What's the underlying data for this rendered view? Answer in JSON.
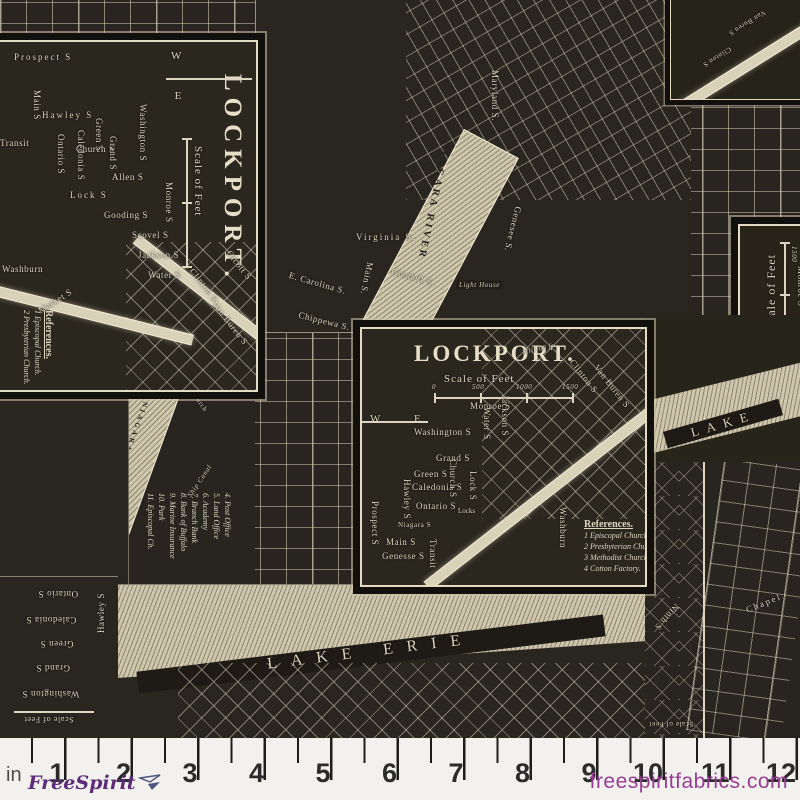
{
  "palette": {
    "background": "#2b2822",
    "line_cream": "#dcd4bd",
    "water": "#cfc6ab",
    "ruler_bg": "#f2f1ee",
    "tick": "#1d1d1d",
    "logo_purple": "#5c2b77",
    "site_purple": "#9a3c96"
  },
  "ruler": {
    "unit": "in",
    "marks": [
      "1",
      "2",
      "3",
      "4",
      "5",
      "6",
      "7",
      "8",
      "9",
      "10",
      "11",
      "12"
    ]
  },
  "brand": {
    "logo": "FreeSpirit",
    "website": "freespiritfabrics.com",
    "glyph": "paper-plane-bird"
  },
  "lockport1": {
    "title": "LOCKPORT.",
    "scale_label": "Scale of Feet",
    "compass": {
      "w": "W",
      "e": "E"
    },
    "streets": {
      "prospect": "Prospect S",
      "main": "Main S",
      "hawley": "Hawley S",
      "transit": "Transit",
      "ontario": "Ontario S",
      "caledonia": "Caledonia S",
      "church": "Church S",
      "green": "Green S",
      "grand": "Grand S",
      "allen": "Allen S",
      "lock": "Lock S",
      "gooding": "Gooding S",
      "scovel": "Scovel S",
      "jackson": "Jackson S",
      "water": "Water S",
      "washington": "Washington S",
      "monroe": "Monroe S",
      "clinton": "Clinton S",
      "vanburen": "Van Buren S",
      "olcott": "Olcott S",
      "washburn": "Washburn",
      "market": "Market S"
    },
    "references_title": "References.",
    "references": [
      "1 Episcopal Church.",
      "2 Presbyterian Church."
    ]
  },
  "lockport2": {
    "title": "LOCKPORT.",
    "scale_label": "Scale of Feet",
    "scale_ticks": [
      "0",
      "500",
      "1000",
      "1500"
    ],
    "compass": {
      "w": "W",
      "e": "E"
    },
    "streets": {
      "monroe": "Monroe S",
      "jackson": "Jackson S",
      "water": "Water S",
      "washington": "Washington S",
      "grand": "Grand S",
      "green": "Green S",
      "caledonia": "Caledonia S",
      "ontario": "Ontario S",
      "main": "Main S",
      "genesse": "Genesse S",
      "niagara": "Niagara S",
      "prospect": "Prospect S",
      "hawley": "Hawley S",
      "lock": "Lock S",
      "church": "Church S",
      "transit": "Transit",
      "washburn": "Washburn",
      "clinton": "Clinton S",
      "vanburen": "Van Buren S",
      "locks": "Locks",
      "mill": "Mill 60 ft"
    },
    "references_title": "References.",
    "references": [
      "1 Episcopal Church.",
      "2 Presbyterian Church.",
      "3 Methodist Church.",
      "4 Cotton Factory."
    ]
  },
  "buffalo": {
    "streets": {
      "virginia": "Virginia S.",
      "carolina": "E. Carolina S.",
      "main": "Main S.",
      "goodell": "Goodell S.",
      "chippewa": "Chippewa S.",
      "genesee": "Genesee S.",
      "maryland": "Maryland S."
    },
    "river": "NIAGARA RIVER",
    "lighthouse": "Light House"
  },
  "refstrip": {
    "items": [
      "4. Post Office",
      "5. Land Office",
      "6. Academy",
      "7. Branch Bank",
      "8. Bank of Buffalo",
      "9. Marine Insurance",
      "10. Park",
      "11. Episcopal Ch."
    ],
    "river": "NIAGARA RIVER",
    "canal": "Ship Canal",
    "church": "Church"
  },
  "rightstrip": {
    "scale_label": "Scale of Feet",
    "scale_ticks": [
      "0",
      "500",
      "1000",
      "1500"
    ],
    "monroe": "Monroe S",
    "references_title": "References.",
    "references": [
      "1. Court House",
      "2. County Jail"
    ],
    "river": "RIVER"
  },
  "rightmid": {
    "lake": "LAKE"
  },
  "bottomcenter": {
    "lake": "LAKE ERIE"
  },
  "bottomleft": {
    "streets": {
      "ontario": "Ontario S",
      "caledonia": "Caledonia S",
      "green": "Green S",
      "grand": "Grand S",
      "washington": "Washington S",
      "hawley": "Hawley S"
    },
    "scale_label": "Scale of Feet"
  },
  "bottomright": {
    "streets": {
      "ninth": "Ninth S",
      "chapel": "Chapel"
    },
    "scale_label": "Scale of Feet"
  },
  "corner": {
    "streets": {
      "vanburen": "Van Buren S",
      "clinton": "Clinton S"
    }
  }
}
